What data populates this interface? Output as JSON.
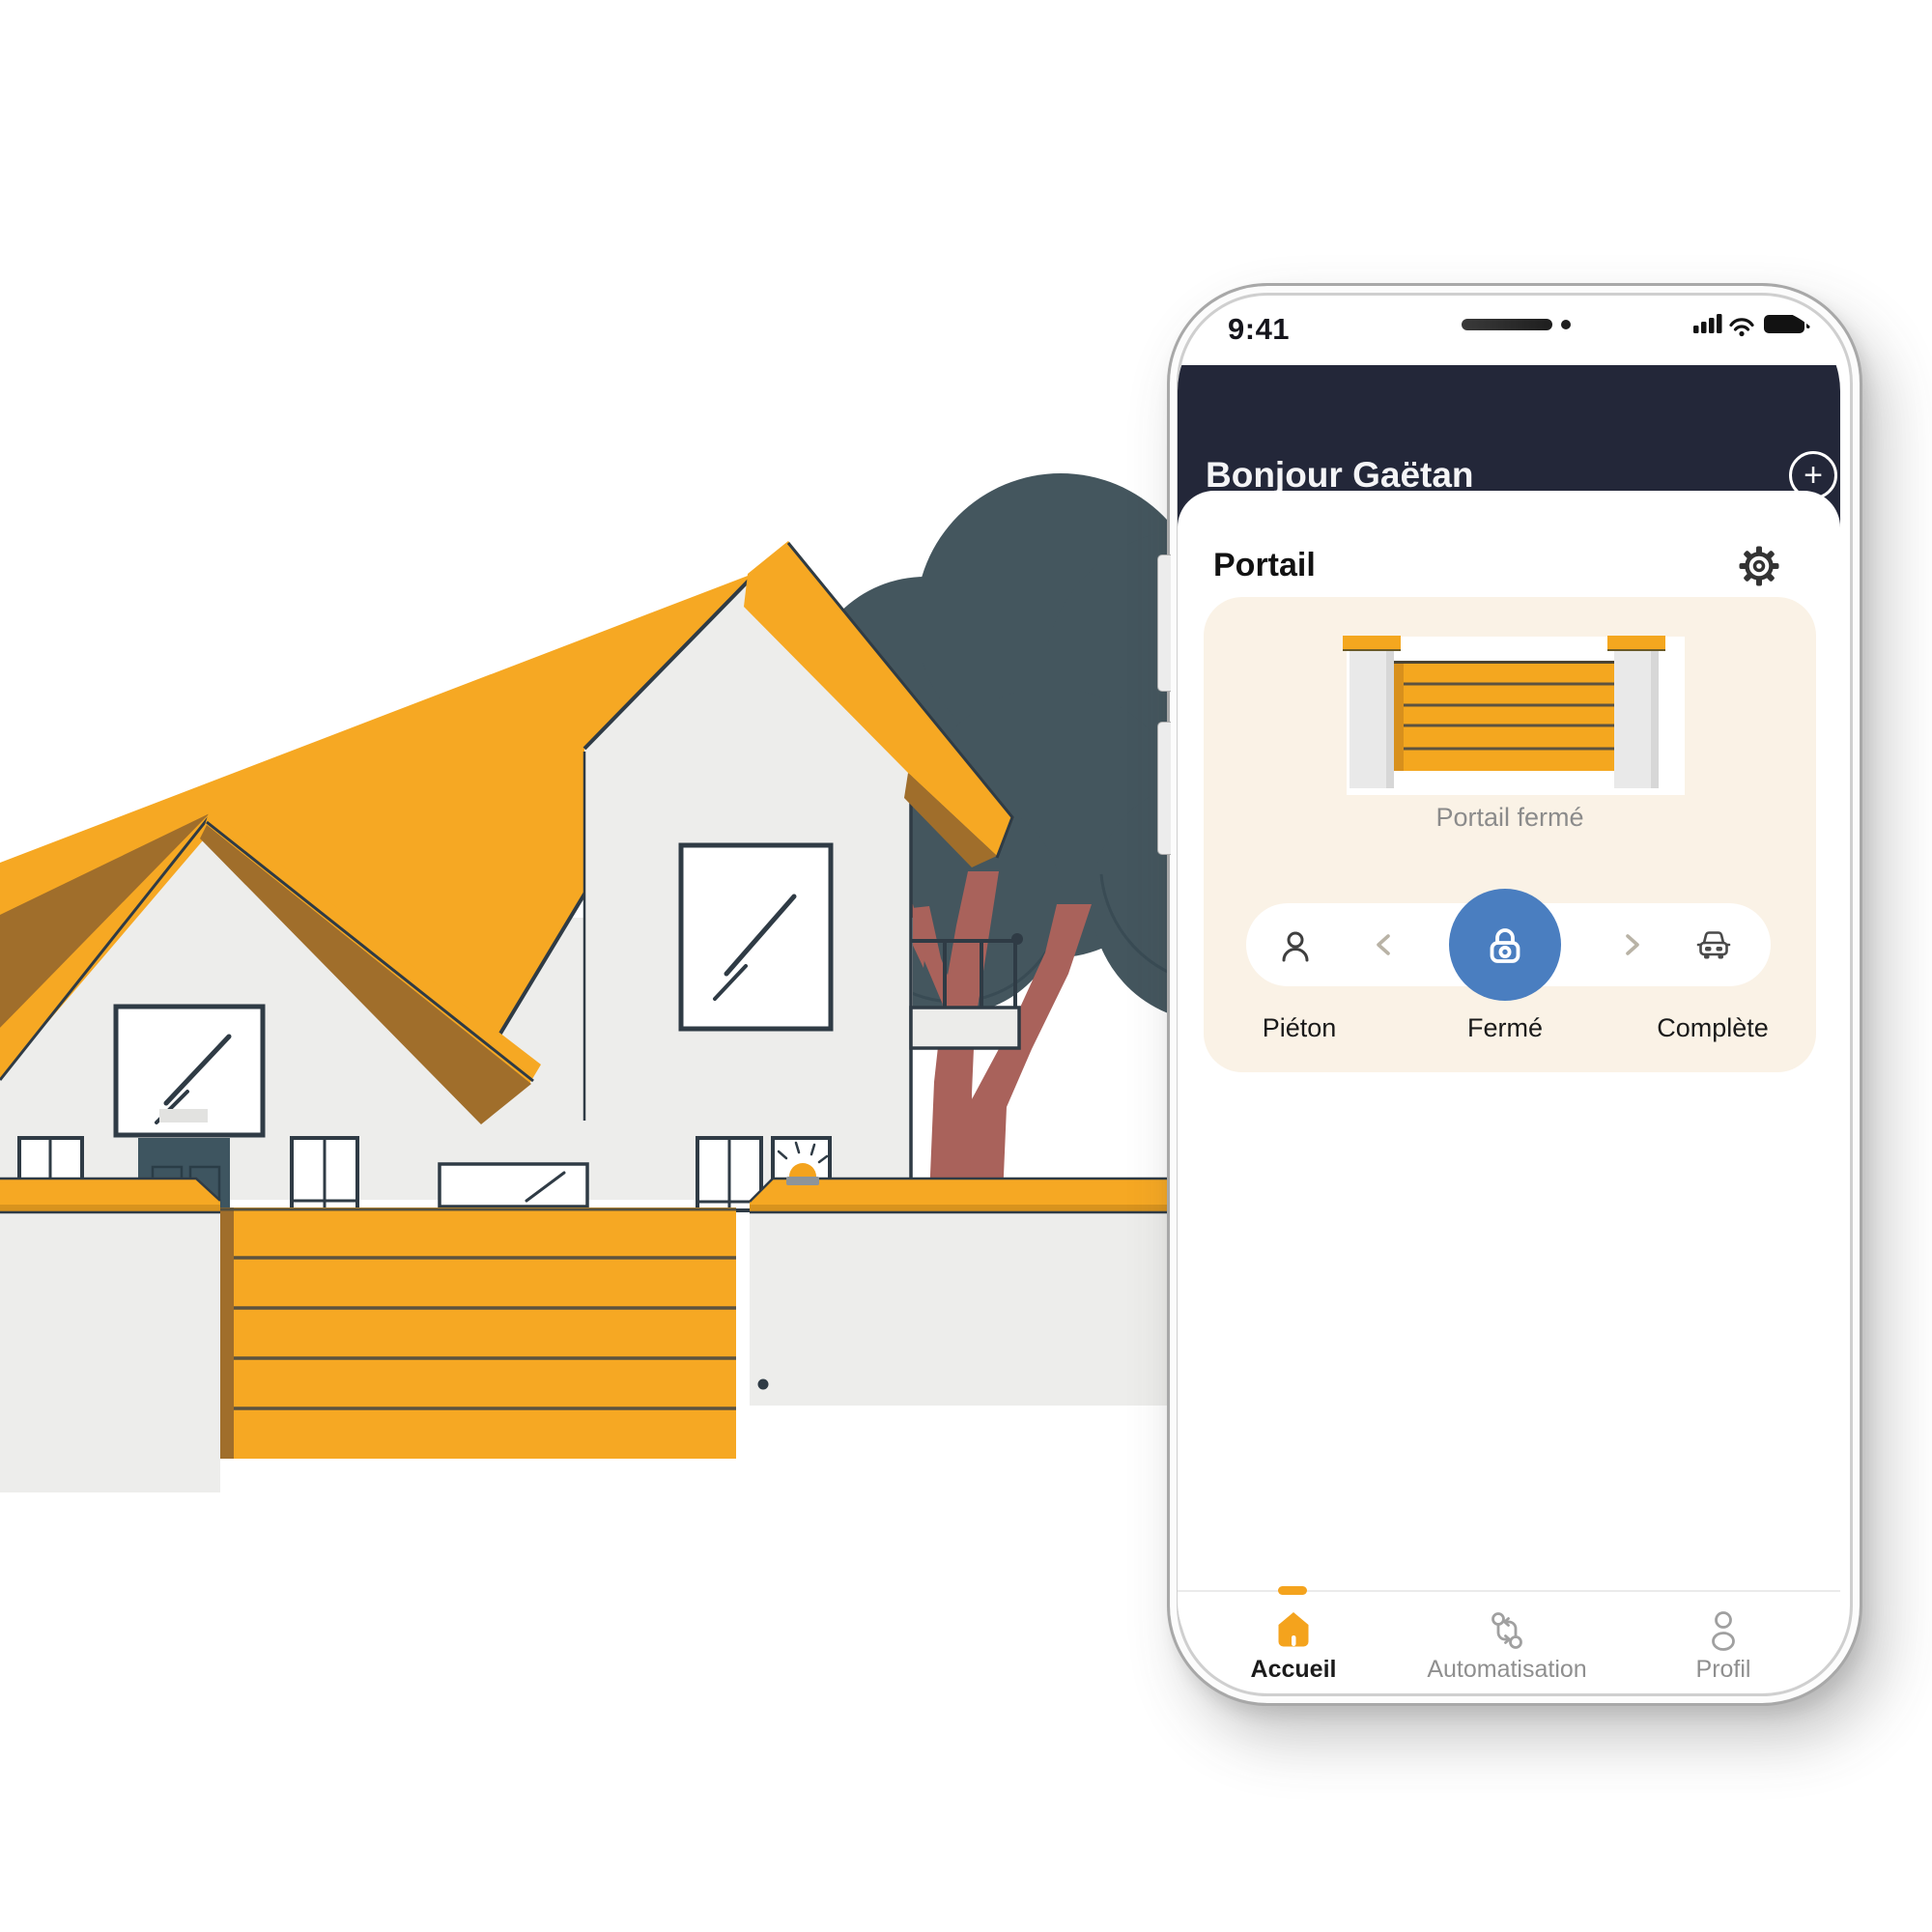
{
  "phone": {
    "status_bar": {
      "time": "9:41",
      "icons": [
        "signal-bars",
        "wifi",
        "battery-full"
      ]
    },
    "header": {
      "greeting": "Bonjour Gaëtan",
      "add_button_icon": "plus-circle"
    },
    "gate_card": {
      "section_title": "Portail",
      "settings_icon": "gear",
      "status_caption": "Portail fermé",
      "controls": {
        "left": {
          "icon": "pedestrian",
          "label": "Piéton"
        },
        "center": {
          "icon": "lock",
          "label": "Fermé"
        },
        "right": {
          "icon": "car",
          "label": "Complète"
        },
        "prev_icon": "chevron-left",
        "next_icon": "chevron-right"
      }
    },
    "nav": {
      "items": [
        {
          "icon": "home",
          "label": "Accueil",
          "active": true
        },
        {
          "icon": "automation",
          "label": "Automatisation",
          "active": false
        },
        {
          "icon": "profile",
          "label": "Profil",
          "active": false
        }
      ]
    }
  },
  "glyphs": {
    "plus": "+"
  },
  "colors": {
    "accent_orange": "#F4A31D",
    "header_navy": "#232739",
    "lock_blue": "#4A7EC0",
    "card_cream": "#FAF2E6",
    "roof_orange": "#F6A823",
    "roof_brown": "#A06E2B",
    "wall_gray": "#EDEDEB",
    "outline_dark": "#2F3B45",
    "tree_canopy": "#44565E",
    "tree_trunk": "#A9625B",
    "muted_text": "#8B8B8B"
  },
  "illustration": {
    "name": "house-with-closed-gate-and-tree"
  }
}
